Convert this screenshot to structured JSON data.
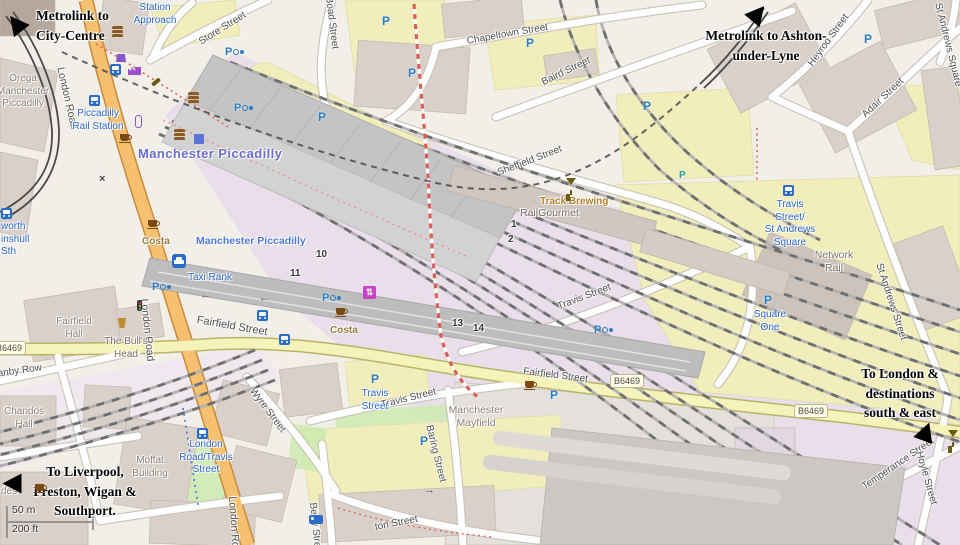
{
  "colors": {
    "background": "#f2efe9",
    "primary_road": "#f5c06f",
    "secondary_road": "#f5f2ba",
    "parking_area": "#f1eebc",
    "railway_landuse": "#e9dee9",
    "building": "#d9d0c9",
    "grass": "#cdebb0",
    "station_label": "#6c6cd1",
    "transit_label": "#2b66c9",
    "poi_label": "#9c7a3c",
    "annotation_text": "#050505",
    "parking_icon": "#2a7ec6",
    "lift_icon": "#c643c6",
    "metrolink_line": "#4a4a4a",
    "footpath": "#d95f57"
  },
  "icons": {
    "parking_glyph": "P",
    "level_crossing_glyph": "×",
    "lift_glyph": "⇅",
    "oneway_left_glyph": "←",
    "oneway_right_glyph": "→"
  },
  "annotations": {
    "metrolink_city": "Metrolink to\nCity-Centre",
    "metrolink_ashton": "Metrolink to Ashton-\nunder-Lyne",
    "to_liverpool": "To Liverpool,\nPreston, Wigan &\nSouthport.",
    "to_london": "To London &\ndestinations\nsouth & east"
  },
  "streets": {
    "london_road": "London Road",
    "station_approach": "Station\nApproach",
    "store": "Store Street",
    "boad": "Boad Street",
    "chapeltown": "Chapeltown Street",
    "baird": "Baird Street",
    "sheffield": "Sheffield Street",
    "heyrod": "Heyrod Street",
    "adair": "Adair Street",
    "st_andrews_square": "St Andrews Square",
    "st_andrews_street": "St Andrews Street",
    "travis": "Travis Street",
    "fairfield": "Fairfield Street",
    "baring": "Baring Street",
    "wyre": "Wyre Street",
    "berry": "Berry Street",
    "ton_fragment": "ton Street",
    "temperance": "Temperance Street",
    "hoyle": "Hoyle Street",
    "granby": "Granby Row"
  },
  "road_refs": {
    "b6469": "B6469",
    "b6469_partial": "469"
  },
  "transit": {
    "piccadilly_rail_station": "Piccadilly\nRail Station",
    "taxi_rank": "Taxi Rank",
    "travis_st_andrews": "Travis\nStreet/\nSt Andrews\nSquare",
    "square_one": "Square\nOne",
    "london_road_travis": "London\nRoad/Travis\nStreet",
    "travis_parking": "Travis\nStreet",
    "stop_fragment": "worth\ninshull\nSth"
  },
  "places": {
    "station_big": "Manchester Piccadilly",
    "station_small": "Manchester Piccadilly",
    "orega": "Orega\nManchester\nPiccadilly",
    "network_rail": "Network\nRail",
    "mayfield": "Manchester\nMayfield",
    "moffat": "Moffat\nBuilding",
    "fairfield_hall": "Fairfield\nHall",
    "bulls_head": "The Bull's\nHead",
    "chandos": "Chandos\nHall",
    "railgourmet": "RailGourmet",
    "track_brewing": "Track Brewing",
    "costa": "Costa",
    "des_fragment": "des"
  },
  "platforms": {
    "p1": "1",
    "p2": "2",
    "p10": "10",
    "p11": "11",
    "p13": "13",
    "p14": "14"
  },
  "scale": {
    "metric": "50 m",
    "imperial": "200 ft"
  }
}
